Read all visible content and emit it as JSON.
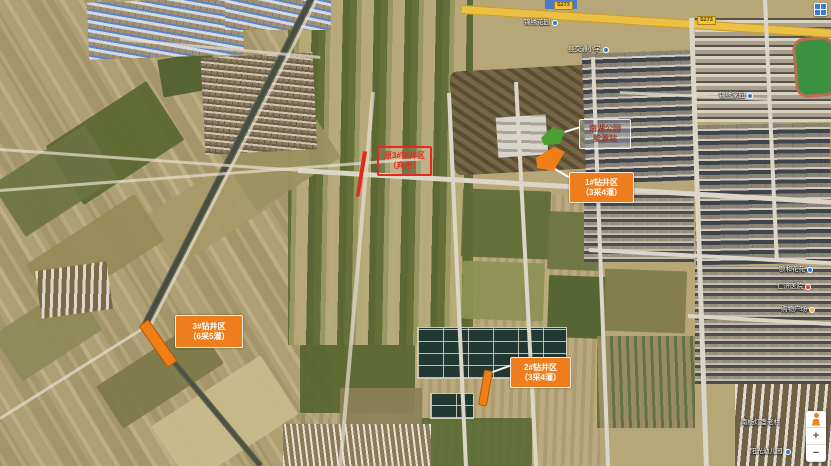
{
  "meta": {
    "view": "satellite-map"
  },
  "colors": {
    "marker_orange": "#ef7d18",
    "marker_red": "#e8281e",
    "marker_green": "#4d9e33",
    "road_yellow": "#ecbf45"
  },
  "annotations": {
    "labels": [
      {
        "id": "old-well-3",
        "line1": "原3#钻井区",
        "line2": "（弃用）"
      },
      {
        "id": "energy-station",
        "line1": "南湖公园",
        "line2": "能源站"
      },
      {
        "id": "well-1",
        "line1": "1#钻井区",
        "line2": "（3采4灌）"
      },
      {
        "id": "well-3",
        "line1": "3#钻井区",
        "line2": "（6采5灌）"
      },
      {
        "id": "well-2",
        "line1": "2#钻井区",
        "line2": "（3采4灌）"
      }
    ],
    "markers": [
      {
        "id": "old-well-3-site",
        "color": "#e02a1c"
      },
      {
        "id": "energy-station-site",
        "color": "#4d9e33"
      },
      {
        "id": "well-1-site",
        "color": "#ef7d18"
      },
      {
        "id": "well-3-site",
        "color": "#ef7d18"
      },
      {
        "id": "well-2-site",
        "color": "#ef7d18"
      }
    ]
  },
  "pois": [
    {
      "name": "锦绣花园",
      "icon": "blue"
    },
    {
      "name": "县交通小学",
      "icon": "blue"
    },
    {
      "name": "锦绣家园",
      "icon": "blue"
    },
    {
      "name": "颐和花苑",
      "icon": "blue"
    },
    {
      "name": "仁济医院",
      "icon": "red"
    },
    {
      "name": "购物广场",
      "icon": "yellow"
    },
    {
      "name": "南杨灯盏老村",
      "icon": "none"
    },
    {
      "name": "阳光幼儿园",
      "icon": "blue"
    }
  ],
  "roads": {
    "route_badge": "S273"
  },
  "controls": {
    "zoom_in": "+",
    "zoom_out": "−"
  }
}
